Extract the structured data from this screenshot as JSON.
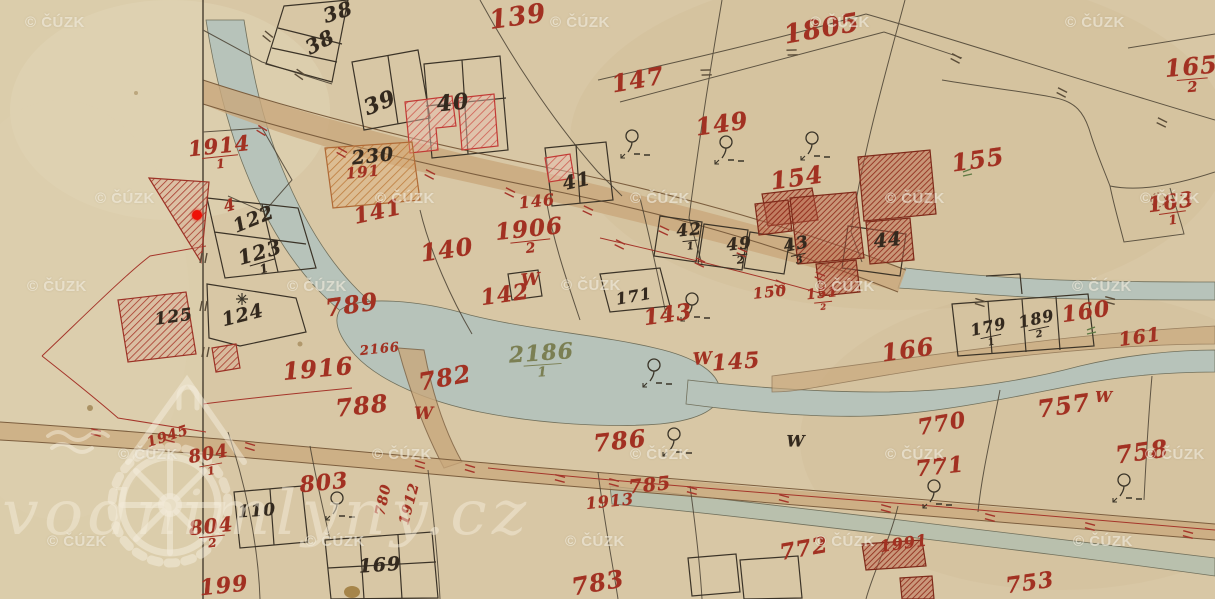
{
  "watermarks": {
    "cuzk": "© ČÚZK",
    "site": "vodnimlyny.cz",
    "cuzk_positions": [
      {
        "x": 25,
        "y": 14
      },
      {
        "x": 550,
        "y": 14
      },
      {
        "x": 810,
        "y": 14
      },
      {
        "x": 1065,
        "y": 14
      },
      {
        "x": 95,
        "y": 190
      },
      {
        "x": 375,
        "y": 190
      },
      {
        "x": 630,
        "y": 190
      },
      {
        "x": 885,
        "y": 190
      },
      {
        "x": 1140,
        "y": 190
      },
      {
        "x": 27,
        "y": 278
      },
      {
        "x": 287,
        "y": 278
      },
      {
        "x": 561,
        "y": 277
      },
      {
        "x": 815,
        "y": 278
      },
      {
        "x": 1072,
        "y": 278
      },
      {
        "x": 118,
        "y": 446
      },
      {
        "x": 372,
        "y": 446
      },
      {
        "x": 630,
        "y": 446
      },
      {
        "x": 885,
        "y": 446
      },
      {
        "x": 1145,
        "y": 446
      },
      {
        "x": 47,
        "y": 533
      },
      {
        "x": 305,
        "y": 533
      },
      {
        "x": 565,
        "y": 533
      },
      {
        "x": 815,
        "y": 533
      },
      {
        "x": 1073,
        "y": 533
      }
    ]
  },
  "map": {
    "ink_colors": {
      "red": "#a23122",
      "black": "#33291e",
      "olive": "#7b7f53"
    },
    "labels": [
      {
        "t": "139",
        "x": 518,
        "y": 18,
        "s": 26,
        "r": -8,
        "c": "red"
      },
      {
        "t": "1805",
        "x": 822,
        "y": 30,
        "s": 26,
        "r": -10,
        "c": "red"
      },
      {
        "t": "165",
        "sub": "2",
        "x": 1192,
        "y": 76,
        "s": 24,
        "r": -5,
        "c": "red"
      },
      {
        "t": "147",
        "x": 638,
        "y": 80,
        "s": 24,
        "r": -10,
        "c": "red"
      },
      {
        "t": "149",
        "x": 722,
        "y": 124,
        "s": 24,
        "r": -8,
        "c": "red"
      },
      {
        "t": "155",
        "x": 978,
        "y": 160,
        "s": 24,
        "r": -8,
        "c": "red"
      },
      {
        "t": "154",
        "x": 797,
        "y": 178,
        "s": 24,
        "r": -8,
        "c": "red"
      },
      {
        "t": "163",
        "sub": "1",
        "x": 1172,
        "y": 210,
        "s": 21,
        "r": -8,
        "c": "red"
      },
      {
        "t": "1914",
        "sub": "1",
        "x": 220,
        "y": 154,
        "s": 21,
        "r": -6,
        "c": "red"
      },
      {
        "t": "191",
        "x": 363,
        "y": 173,
        "s": 15,
        "r": -6,
        "c": "red"
      },
      {
        "t": "141",
        "x": 378,
        "y": 212,
        "s": 22,
        "r": -12,
        "c": "red"
      },
      {
        "t": "146",
        "x": 537,
        "y": 202,
        "s": 16,
        "r": -6,
        "c": "red"
      },
      {
        "t": "1906",
        "sub": "2",
        "x": 530,
        "y": 238,
        "s": 23,
        "r": -6,
        "c": "red"
      },
      {
        "t": "140",
        "x": 447,
        "y": 250,
        "s": 24,
        "r": -8,
        "c": "red"
      },
      {
        "t": "142",
        "x": 505,
        "y": 295,
        "s": 22,
        "r": -8,
        "c": "red"
      },
      {
        "t": "W",
        "x": 531,
        "y": 281,
        "s": 17,
        "r": -5,
        "c": "red"
      },
      {
        "t": "143",
        "x": 668,
        "y": 315,
        "s": 22,
        "r": -8,
        "c": "red"
      },
      {
        "t": "W",
        "x": 703,
        "y": 360,
        "s": 17,
        "r": -4,
        "c": "red"
      },
      {
        "t": "145",
        "x": 736,
        "y": 362,
        "s": 22,
        "r": -4,
        "c": "red"
      },
      {
        "t": "150",
        "x": 770,
        "y": 293,
        "s": 15,
        "r": -6,
        "c": "red"
      },
      {
        "t": "151",
        "sub": "2",
        "x": 823,
        "y": 300,
        "s": 14,
        "r": -6,
        "c": "red"
      },
      {
        "t": "166",
        "x": 908,
        "y": 350,
        "s": 24,
        "r": -8,
        "c": "red"
      },
      {
        "t": "160",
        "x": 1086,
        "y": 312,
        "s": 22,
        "r": -8,
        "c": "red"
      },
      {
        "t": "161",
        "x": 1140,
        "y": 338,
        "s": 19,
        "r": -8,
        "c": "red"
      },
      {
        "t": "789",
        "x": 352,
        "y": 305,
        "s": 24,
        "r": -8,
        "c": "red"
      },
      {
        "t": "2166",
        "x": 380,
        "y": 350,
        "s": 13,
        "r": -6,
        "c": "red"
      },
      {
        "t": "1916",
        "x": 318,
        "y": 369,
        "s": 24,
        "r": -5,
        "c": "red"
      },
      {
        "t": "782",
        "x": 445,
        "y": 378,
        "s": 24,
        "r": -10,
        "c": "red"
      },
      {
        "t": "788",
        "x": 362,
        "y": 406,
        "s": 24,
        "r": -6,
        "c": "red"
      },
      {
        "t": "W",
        "x": 424,
        "y": 415,
        "s": 17,
        "r": 0,
        "c": "red"
      },
      {
        "t": "786",
        "x": 620,
        "y": 441,
        "s": 24,
        "r": -6,
        "c": "red"
      },
      {
        "t": "785",
        "x": 650,
        "y": 486,
        "s": 19,
        "r": -6,
        "c": "red"
      },
      {
        "t": "1913",
        "x": 610,
        "y": 502,
        "s": 16,
        "r": -6,
        "c": "red"
      },
      {
        "t": "804",
        "sub": "1",
        "x": 210,
        "y": 462,
        "s": 18,
        "r": -10,
        "c": "red"
      },
      {
        "t": "804",
        "sub": "2",
        "x": 212,
        "y": 534,
        "s": 20,
        "r": -6,
        "c": "red"
      },
      {
        "t": "1945",
        "x": 168,
        "y": 437,
        "s": 14,
        "r": -18,
        "c": "red"
      },
      {
        "t": "803",
        "x": 324,
        "y": 483,
        "s": 22,
        "r": -6,
        "c": "red"
      },
      {
        "t": "199",
        "x": 224,
        "y": 586,
        "s": 22,
        "r": -6,
        "c": "red"
      },
      {
        "t": "783",
        "x": 598,
        "y": 583,
        "s": 24,
        "r": -10,
        "c": "red"
      },
      {
        "t": "772",
        "x": 804,
        "y": 549,
        "s": 22,
        "r": -10,
        "c": "red"
      },
      {
        "t": "1991",
        "x": 904,
        "y": 544,
        "s": 16,
        "r": -8,
        "c": "red"
      },
      {
        "t": "770",
        "x": 942,
        "y": 424,
        "s": 22,
        "r": -10,
        "c": "red"
      },
      {
        "t": "771",
        "x": 940,
        "y": 467,
        "s": 22,
        "r": -6,
        "c": "red"
      },
      {
        "t": "757",
        "x": 1064,
        "y": 406,
        "s": 24,
        "r": -8,
        "c": "red"
      },
      {
        "t": "W",
        "x": 1104,
        "y": 398,
        "s": 15,
        "r": 0,
        "c": "red"
      },
      {
        "t": "758",
        "x": 1142,
        "y": 452,
        "s": 24,
        "r": -8,
        "c": "red"
      },
      {
        "t": "753",
        "x": 1030,
        "y": 583,
        "s": 22,
        "r": -8,
        "c": "red"
      },
      {
        "t": "780",
        "x": 384,
        "y": 500,
        "s": 14,
        "r": -78,
        "c": "red"
      },
      {
        "t": "1912",
        "x": 410,
        "y": 504,
        "s": 14,
        "r": -75,
        "c": "red"
      },
      {
        "t": "4",
        "x": 230,
        "y": 206,
        "s": 16,
        "r": -15,
        "c": "red"
      },
      {
        "t": "38",
        "x": 338,
        "y": 12,
        "s": 20,
        "r": -18,
        "c": "black"
      },
      {
        "t": "38",
        "x": 320,
        "y": 42,
        "s": 20,
        "r": -28,
        "c": "black"
      },
      {
        "t": "39",
        "x": 380,
        "y": 103,
        "s": 22,
        "r": -22,
        "c": "black"
      },
      {
        "t": "40",
        "x": 453,
        "y": 103,
        "s": 22,
        "r": -6,
        "c": "black"
      },
      {
        "t": "230",
        "x": 373,
        "y": 157,
        "s": 19,
        "r": -6,
        "c": "black"
      },
      {
        "t": "41",
        "x": 577,
        "y": 182,
        "s": 19,
        "r": -12,
        "c": "black"
      },
      {
        "t": "42",
        "sub": "1",
        "x": 690,
        "y": 238,
        "s": 17,
        "r": -6,
        "c": "black"
      },
      {
        "t": "49",
        "sub": "2",
        "x": 740,
        "y": 252,
        "s": 17,
        "r": -6,
        "c": "black"
      },
      {
        "t": "43",
        "sub": "3",
        "x": 798,
        "y": 252,
        "s": 17,
        "r": -12,
        "c": "black"
      },
      {
        "t": "44",
        "x": 888,
        "y": 241,
        "s": 19,
        "r": -6,
        "c": "black"
      },
      {
        "t": "171",
        "x": 634,
        "y": 297,
        "s": 16,
        "r": -10,
        "c": "black"
      },
      {
        "t": "122",
        "x": 254,
        "y": 220,
        "s": 19,
        "r": -22,
        "c": "black"
      },
      {
        "t": "123",
        "sub": "1",
        "x": 262,
        "y": 260,
        "s": 20,
        "r": -16,
        "c": "black"
      },
      {
        "t": "124",
        "x": 243,
        "y": 316,
        "s": 19,
        "r": -14,
        "c": "black"
      },
      {
        "t": "125",
        "x": 174,
        "y": 318,
        "s": 17,
        "r": -8,
        "c": "black"
      },
      {
        "t": "110",
        "x": 257,
        "y": 512,
        "s": 17,
        "r": -4,
        "c": "black"
      },
      {
        "t": "169",
        "x": 380,
        "y": 566,
        "s": 19,
        "r": -4,
        "c": "black"
      },
      {
        "t": "179",
        "sub": "1",
        "x": 990,
        "y": 334,
        "s": 16,
        "r": -12,
        "c": "black"
      },
      {
        "t": "189",
        "sub": "2",
        "x": 1038,
        "y": 326,
        "s": 16,
        "r": -12,
        "c": "black"
      },
      {
        "t": "W",
        "x": 796,
        "y": 442,
        "s": 16,
        "r": 0,
        "c": "black"
      },
      {
        "t": "2186",
        "sub": "1",
        "x": 542,
        "y": 362,
        "s": 22,
        "r": -4,
        "c": "olive"
      }
    ],
    "trees": [
      [
        632,
        140
      ],
      [
        726,
        146
      ],
      [
        812,
        142
      ],
      [
        692,
        303
      ],
      [
        654,
        369
      ],
      [
        337,
        502
      ],
      [
        674,
        438
      ],
      [
        934,
        490
      ],
      [
        1124,
        484
      ]
    ],
    "green_marks": [
      [
        1092,
        330
      ],
      [
        968,
        172
      ]
    ],
    "ticks": [
      [
        262,
        130,
        20,
        "r"
      ],
      [
        342,
        152,
        18,
        "r"
      ],
      [
        430,
        174,
        16,
        "r"
      ],
      [
        510,
        192,
        15,
        "r"
      ],
      [
        588,
        210,
        14,
        "r"
      ],
      [
        664,
        230,
        14,
        "r"
      ],
      [
        742,
        252,
        13,
        "r"
      ],
      [
        820,
        276,
        13,
        "r"
      ],
      [
        96,
        432,
        4,
        "r"
      ],
      [
        170,
        438,
        4,
        "r"
      ],
      [
        250,
        446,
        5,
        "r"
      ],
      [
        420,
        464,
        5,
        "r"
      ],
      [
        470,
        468,
        5,
        "r"
      ],
      [
        560,
        478,
        4,
        "r"
      ],
      [
        614,
        482,
        4,
        "r"
      ],
      [
        692,
        490,
        4,
        "r"
      ],
      [
        784,
        498,
        4,
        "r"
      ],
      [
        886,
        508,
        4,
        "r"
      ],
      [
        990,
        517,
        4,
        "r"
      ],
      [
        1090,
        526,
        4,
        "r"
      ],
      [
        1188,
        534,
        4,
        "r"
      ],
      [
        706,
        72,
        -13,
        "k"
      ],
      [
        792,
        52,
        -13,
        "k"
      ],
      [
        956,
        58,
        17,
        "k"
      ],
      [
        1062,
        92,
        16,
        "k"
      ],
      [
        1162,
        122,
        15,
        "k"
      ],
      [
        268,
        36,
        28,
        "k"
      ],
      [
        300,
        74,
        24,
        "k"
      ],
      [
        204,
        258,
        90,
        "k"
      ],
      [
        204,
        306,
        90,
        "k"
      ],
      [
        206,
        352,
        90,
        "k"
      ],
      [
        620,
        244,
        15,
        "r"
      ],
      [
        700,
        262,
        14,
        "r"
      ],
      [
        780,
        284,
        13,
        "r"
      ],
      [
        980,
        302,
        6,
        "k"
      ],
      [
        1110,
        300,
        4,
        "k"
      ]
    ],
    "symbols": {
      "red_dot": {
        "x": 197,
        "y": 215,
        "color": "#ee1208"
      },
      "star": {
        "x": 242,
        "y": 299
      },
      "dotted_circle": {
        "x": 1158,
        "y": 200
      }
    }
  }
}
